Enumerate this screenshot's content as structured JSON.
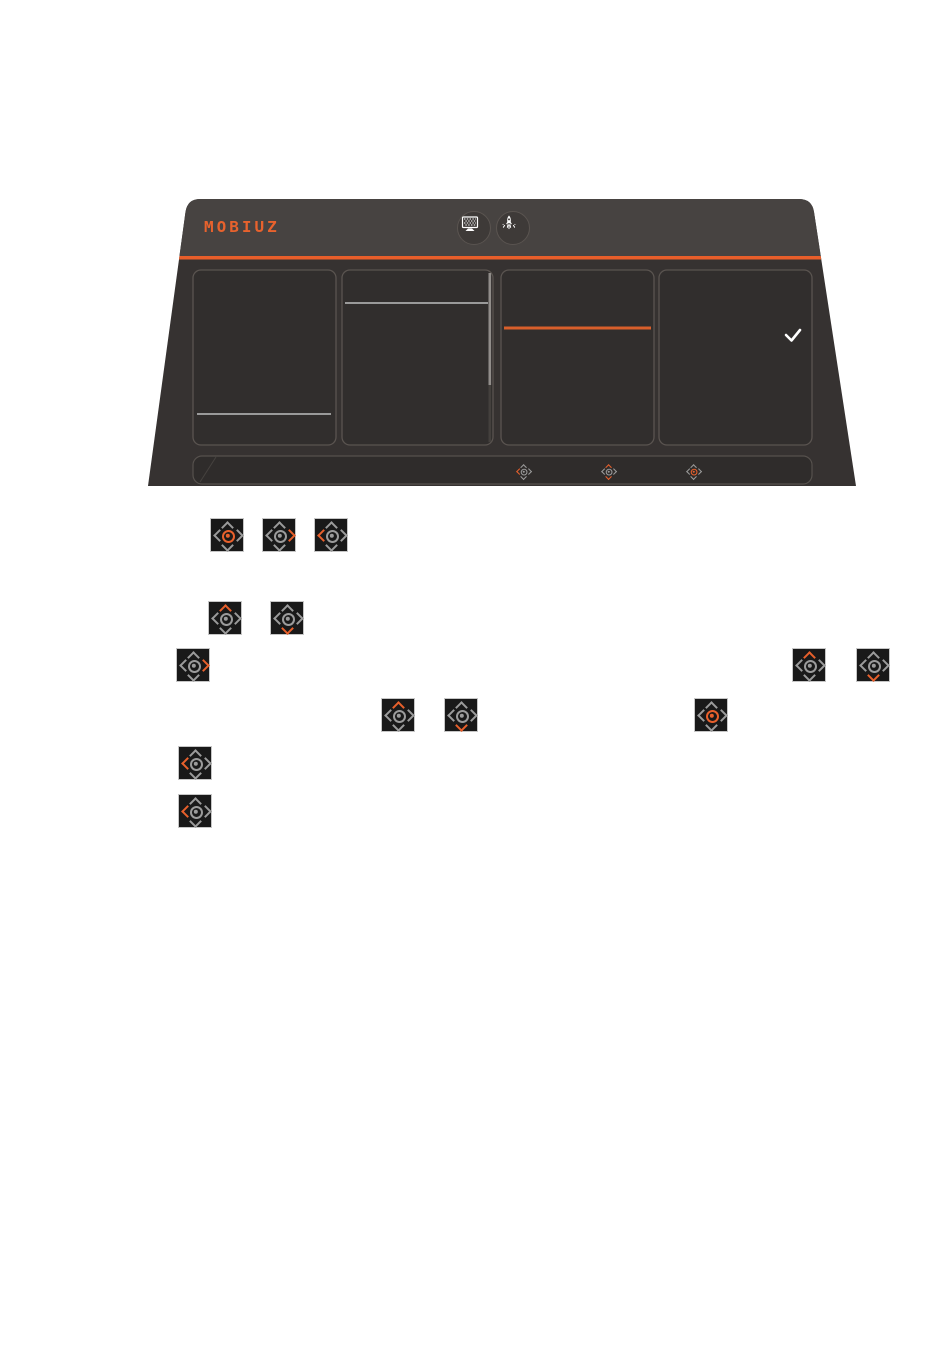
{
  "page": {
    "kind": "monitor-manual-illustration",
    "background": "#ffffff"
  },
  "colors": {
    "accent_orange": "#e8602c",
    "osd_body": "#363231",
    "osd_header_band": "#474341",
    "panel_fill": "#312e2d",
    "panel_border": "#5a5450",
    "gray_divider": "#9a9a9a",
    "joystick_gray": "#9b9b9b",
    "check_white": "#ffffff"
  },
  "osd": {
    "brand": "MOBIUZ",
    "header_icons": [
      {
        "name": "display-scenario-icon"
      },
      {
        "name": "game-rocket-icon"
      }
    ],
    "panels": [
      {
        "name": "menu-column-1",
        "divider": "gray-line-near-bottom"
      },
      {
        "name": "menu-column-2",
        "divider": "gray-line-near-top",
        "scrollbar": "thumb-upper-part"
      },
      {
        "name": "menu-column-3",
        "divider": "orange-highlight-line"
      },
      {
        "name": "menu-column-4",
        "check": "selected-checkmark"
      }
    ],
    "hotkey_bar_icons": [
      {
        "cx": 384,
        "cy": 274,
        "highlight": "left"
      },
      {
        "cx": 469,
        "cy": 274,
        "highlight": "up-down"
      },
      {
        "cx": 554,
        "cy": 274,
        "highlight": "center"
      }
    ]
  },
  "manual_icons": [
    {
      "x": 210,
      "y": 518,
      "highlight": "center"
    },
    {
      "x": 262,
      "y": 518,
      "highlight": "right"
    },
    {
      "x": 314,
      "y": 518,
      "highlight": "left"
    },
    {
      "x": 208,
      "y": 601,
      "highlight": "up"
    },
    {
      "x": 270,
      "y": 601,
      "highlight": "down"
    },
    {
      "x": 176,
      "y": 648,
      "highlight": "right"
    },
    {
      "x": 792,
      "y": 648,
      "highlight": "up"
    },
    {
      "x": 856,
      "y": 648,
      "highlight": "down"
    },
    {
      "x": 381,
      "y": 698,
      "highlight": "up"
    },
    {
      "x": 444,
      "y": 698,
      "highlight": "down"
    },
    {
      "x": 694,
      "y": 698,
      "highlight": "center"
    },
    {
      "x": 178,
      "y": 746,
      "highlight": "left"
    },
    {
      "x": 178,
      "y": 794,
      "highlight": "left"
    }
  ]
}
